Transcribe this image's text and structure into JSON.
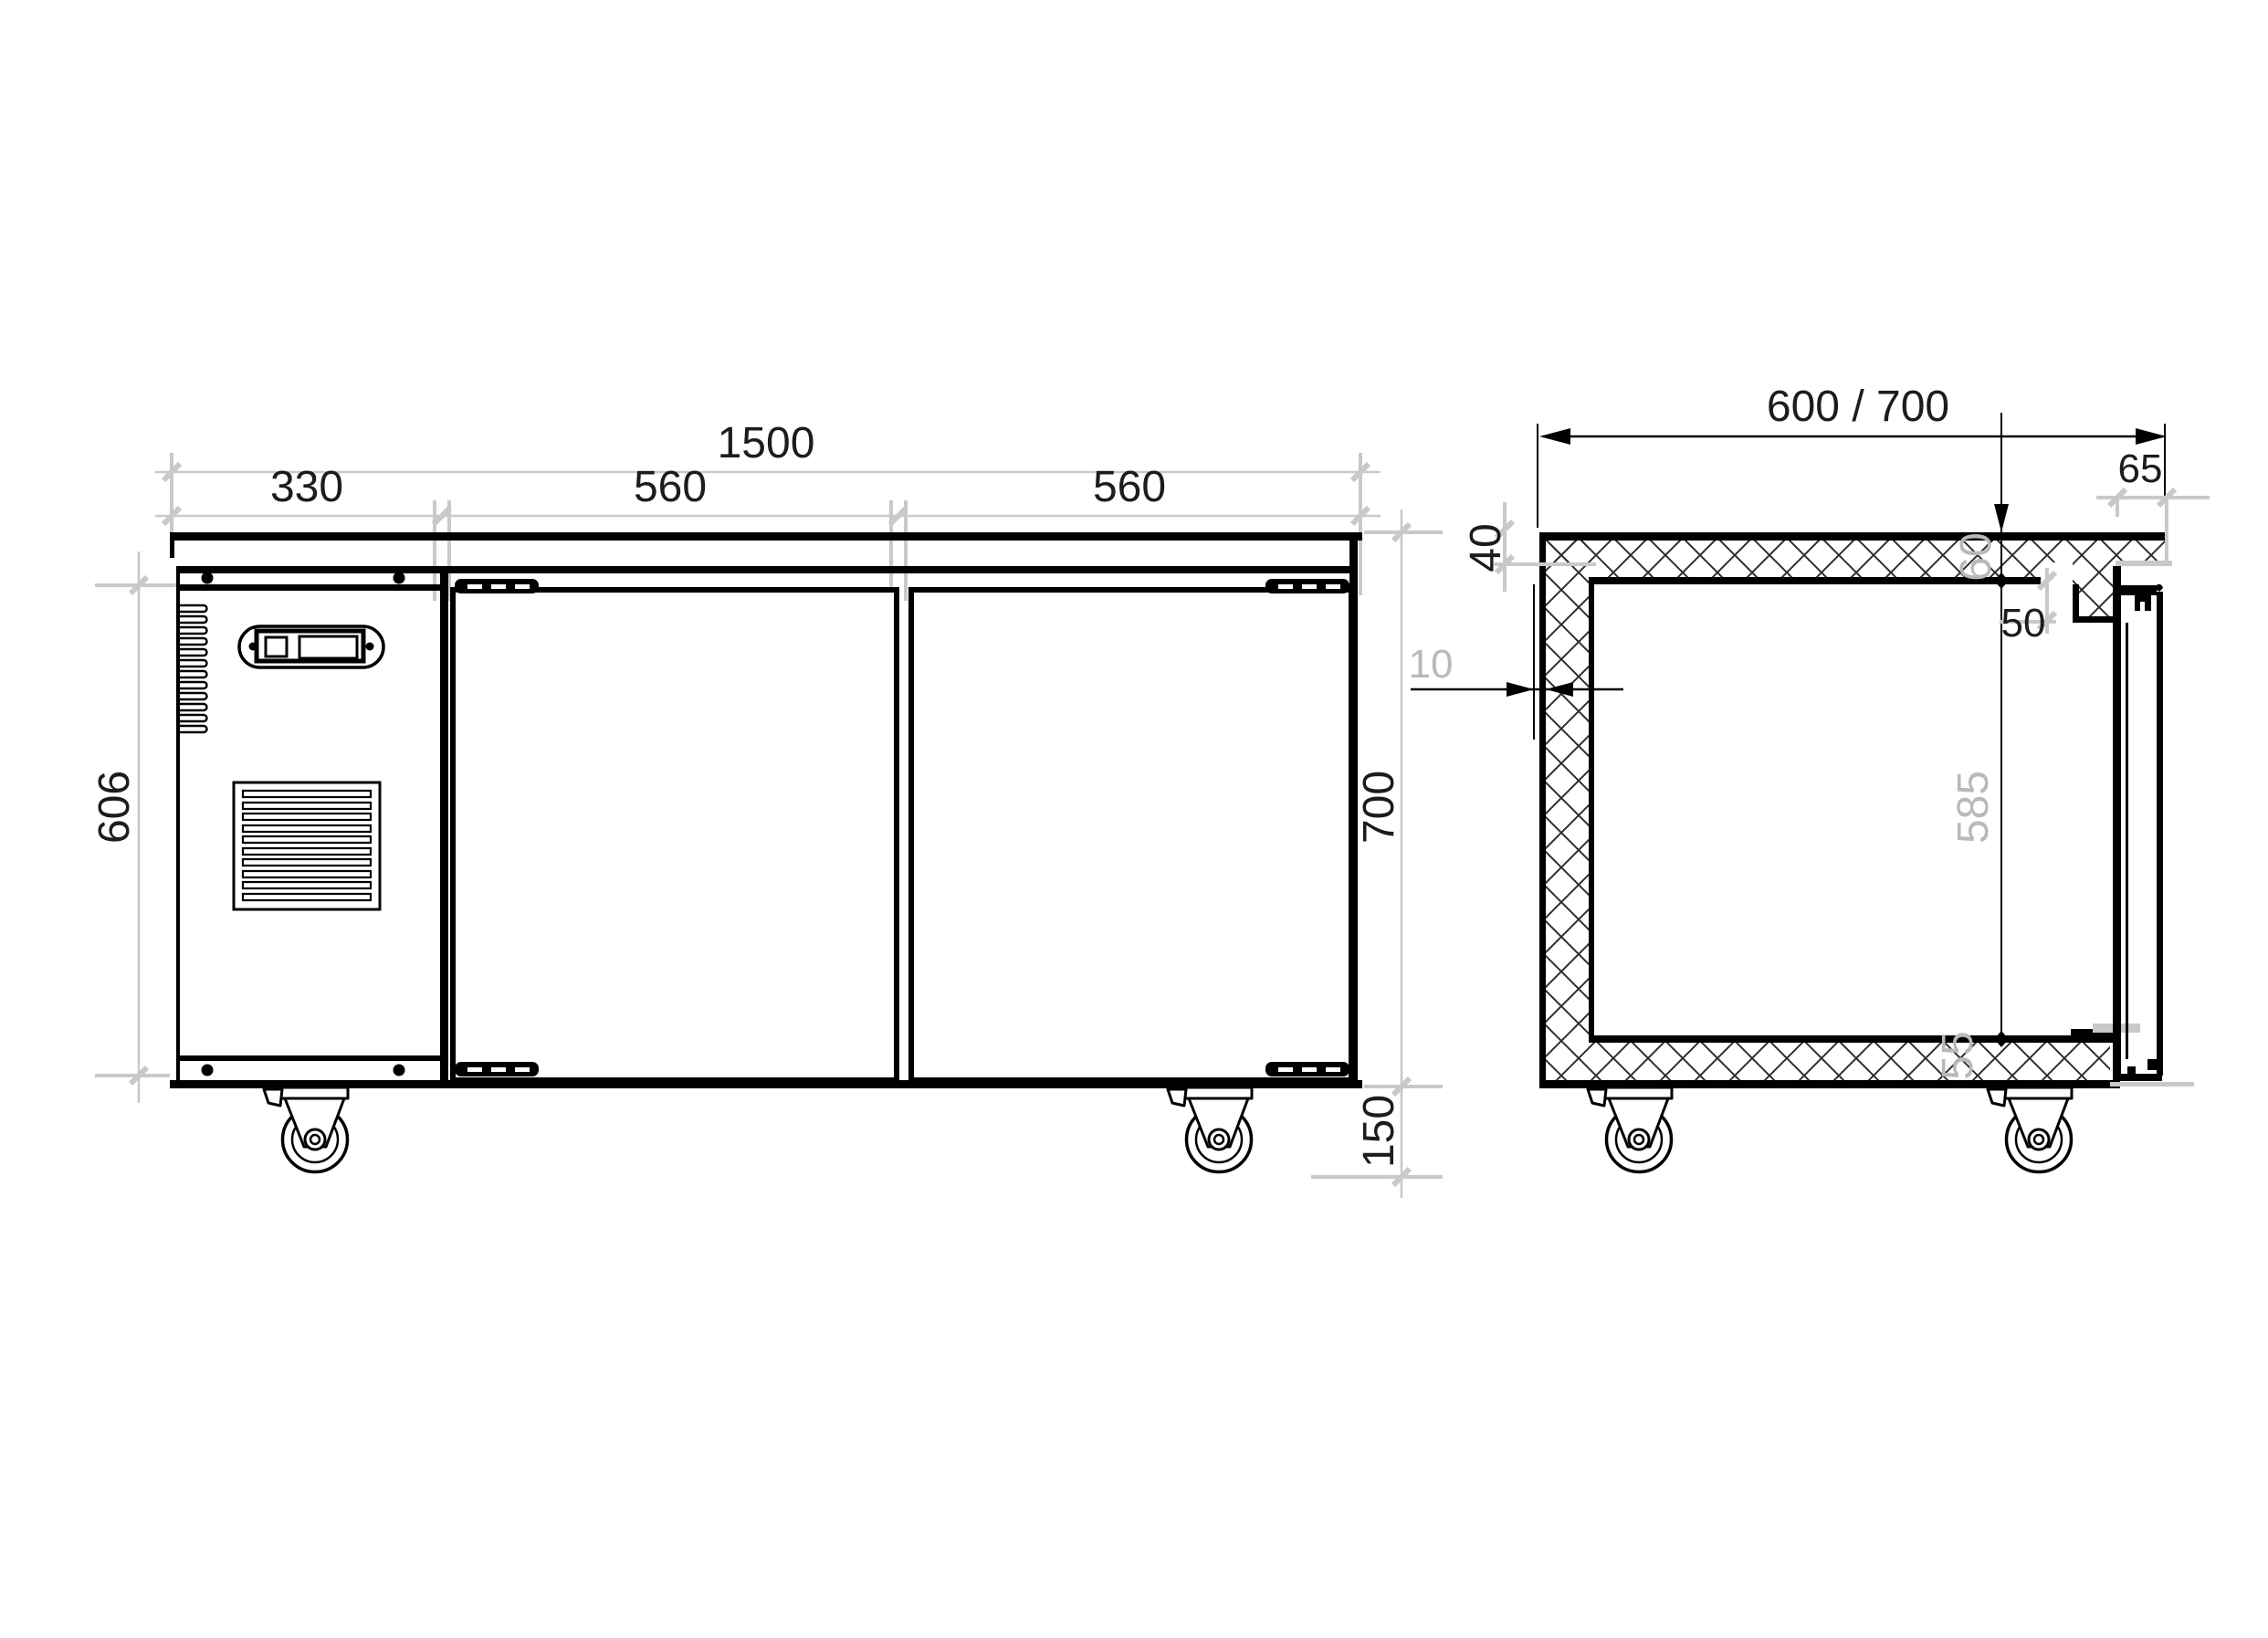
{
  "front_view": {
    "dim_total_width": "1500",
    "dim_section_compressor": "330",
    "dim_section_door1": "560",
    "dim_section_door2": "560",
    "dim_body_height": "606",
    "dim_total_height": "700",
    "dim_caster_height": "150"
  },
  "side_view": {
    "dim_depth": "600 / 700",
    "dim_top_edge": "40",
    "dim_wall_gap": "10",
    "dim_top_thickness": "60",
    "dim_interior_height": "585",
    "dim_bottom_thickness": "55",
    "dim_door_overhang": "65",
    "dim_frame_width": "50"
  },
  "colors": {
    "dim_line": "#c9c9c9",
    "dim_text": "#1c1c1c",
    "ref_text": "#b9b9b9",
    "line": "#000000",
    "background": "#ffffff"
  }
}
